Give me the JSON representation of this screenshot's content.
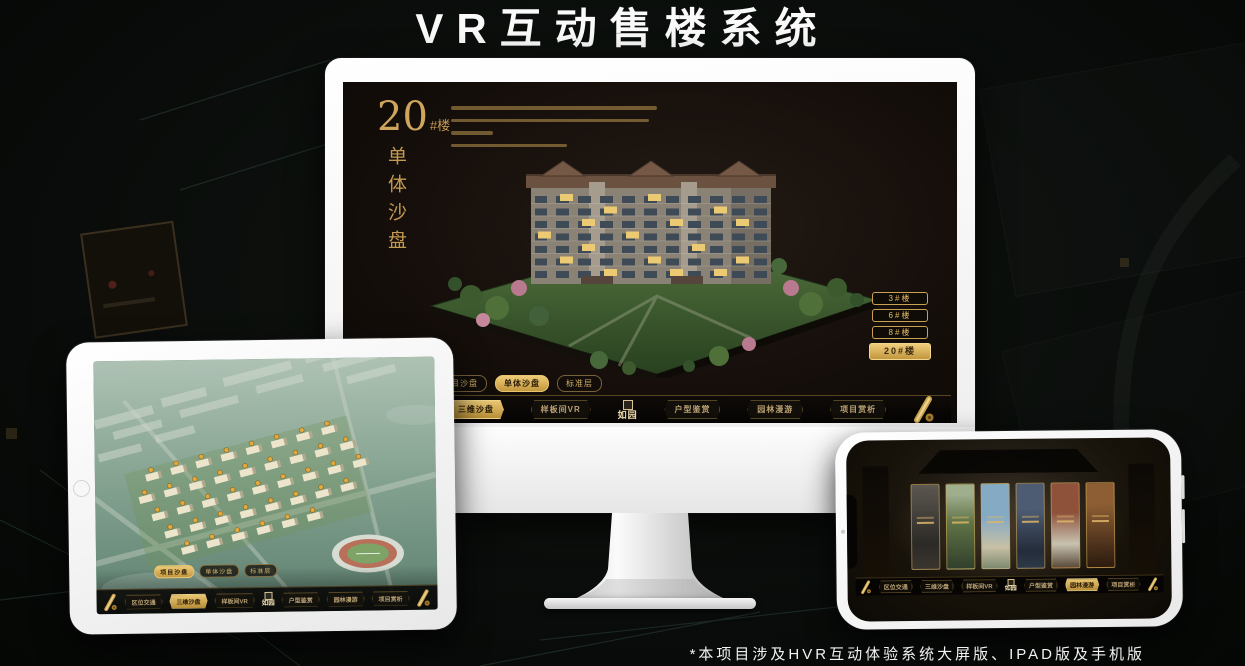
{
  "page": {
    "title": "VR互动售楼系统",
    "footnote": "*本项目涉及HVR互动体验系统大屏版、IPAD版及手机版"
  },
  "colors": {
    "gold": "#c9a254",
    "gold_bright": "#e8c670",
    "screen_bg": "#171210",
    "device_body": "#f5f5f5"
  },
  "nav": {
    "logo": "如园",
    "items": [
      "区位交通",
      "三维沙盘",
      "样板间VR",
      "户型鉴赏",
      "园林漫游",
      "项目赏析"
    ],
    "end_icon": "scroll-icon"
  },
  "monitor": {
    "hero_number": "20",
    "hero_suffix": "#楼",
    "hero_title": "单体沙盘",
    "floor_buttons": [
      "3#楼",
      "6#楼",
      "8#楼",
      "20#楼"
    ],
    "active_floor": "20#楼",
    "sub_tabs": [
      "项目沙盘",
      "单体沙盘",
      "标准层"
    ],
    "active_sub_tab": "单体沙盘",
    "active_nav_item": "三维沙盘"
  },
  "tablet": {
    "sub_tabs": [
      "项目沙盘",
      "单体沙盘",
      "标准层"
    ],
    "active_sub_tab": "项目沙盘",
    "active_nav_item": "三维沙盘"
  },
  "phone": {
    "active_nav_item": "园林漫游",
    "gallery_card_count": 6
  }
}
